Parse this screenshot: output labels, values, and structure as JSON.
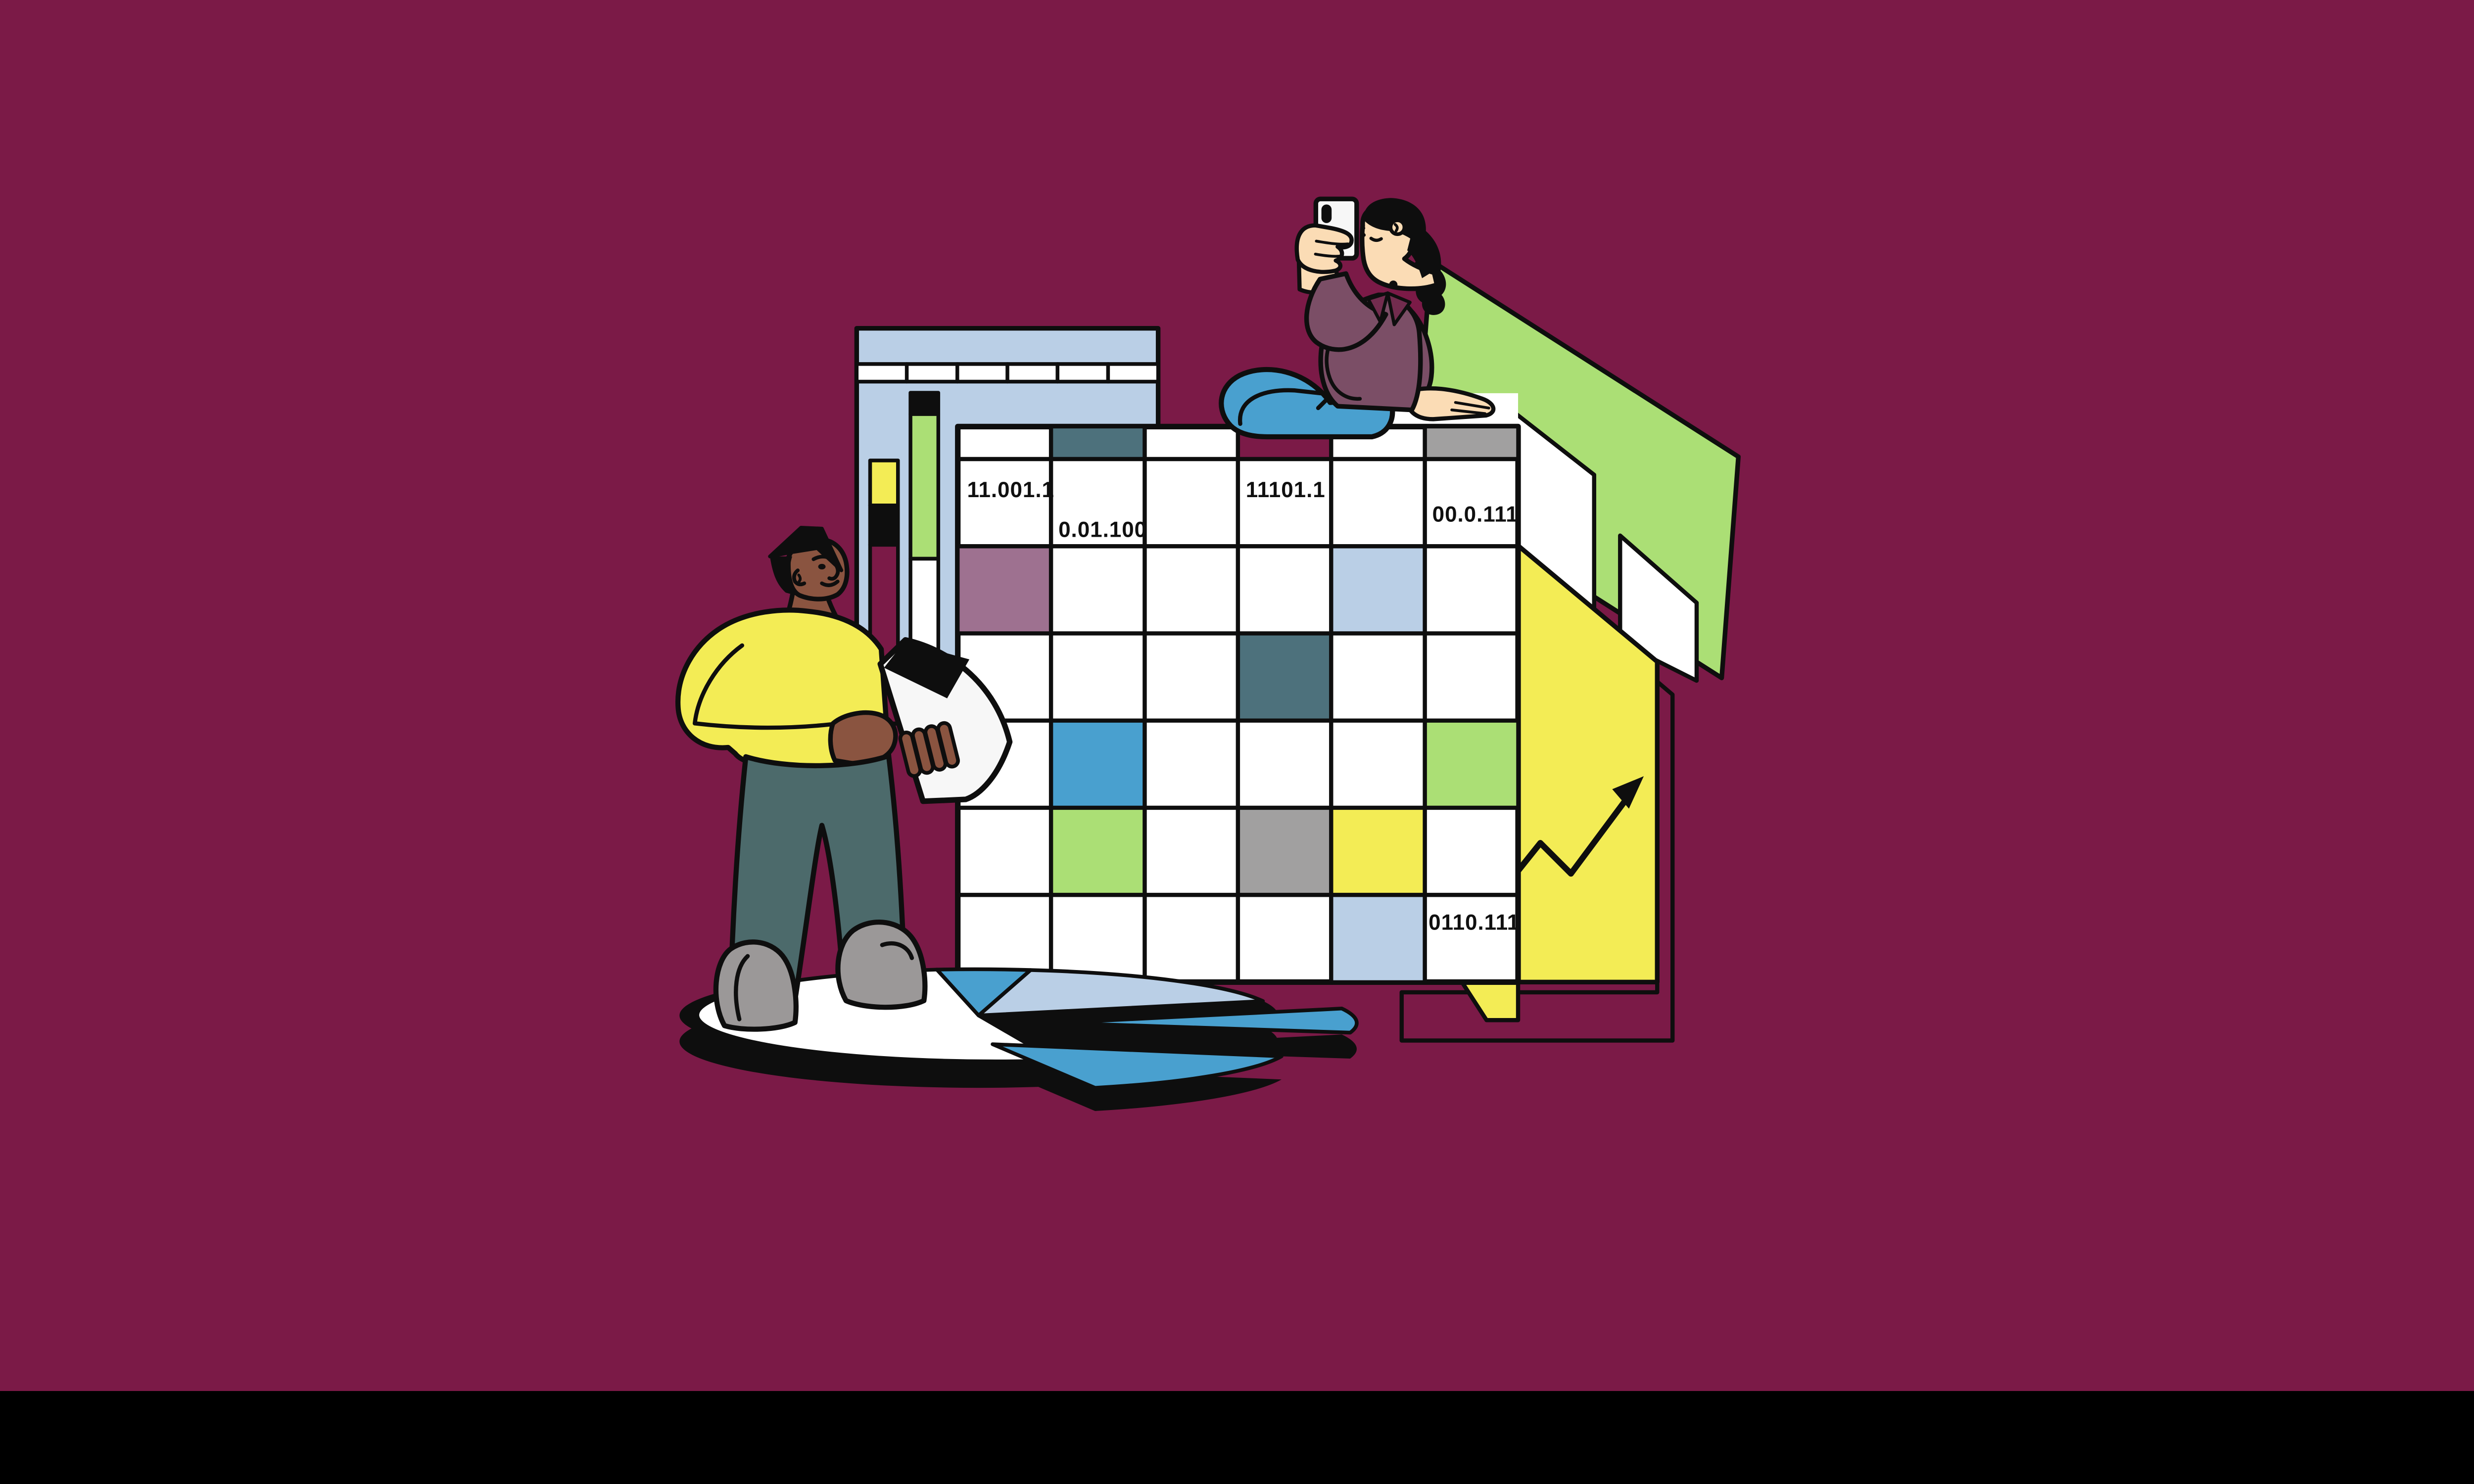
{
  "spreadsheet": {
    "labels": {
      "r1c1": "11.001.1",
      "r1c2": "0.01.100",
      "r1c4": "11101.1",
      "r1c6": "00.0.111",
      "r6c6": "0110.111"
    },
    "colored_cells": [
      {
        "row": 0,
        "col": 2,
        "color": "teal"
      },
      {
        "row": 0,
        "col": 4,
        "color": "burgundy"
      },
      {
        "row": 0,
        "col": 6,
        "color": "gray"
      },
      {
        "row": 2,
        "col": 1,
        "color": "mauve"
      },
      {
        "row": 2,
        "col": 5,
        "color": "light_blue"
      },
      {
        "row": 3,
        "col": 4,
        "color": "teal"
      },
      {
        "row": 4,
        "col": 2,
        "color": "mid_blue"
      },
      {
        "row": 4,
        "col": 6,
        "color": "green"
      },
      {
        "row": 5,
        "col": 2,
        "color": "green"
      },
      {
        "row": 5,
        "col": 4,
        "color": "gray"
      },
      {
        "row": 5,
        "col": 5,
        "color": "yellow"
      },
      {
        "row": 6,
        "col": 5,
        "color": "light_blue"
      }
    ],
    "bar_chart_segments": {
      "bar_a": [
        "yellow",
        "black",
        "burgundy"
      ],
      "bar_b": [
        "black",
        "green",
        "white"
      ]
    }
  },
  "colors": {
    "background": "#7B1A47",
    "ink": "#0e0e0e",
    "paper": "#F7F7F7",
    "white": "#FFFFFF",
    "light_blue": "#BACFE6",
    "mid_blue": "#49A0CF",
    "teal_cell": "#4D717C",
    "slate": "#4C6A6B",
    "mauve": "#9E7190",
    "gray": "#A1A0A0",
    "yellow": "#F3EC55",
    "green": "#ABDF75",
    "plum": "#7B4E66",
    "collar": "#722C4E",
    "skin_light": "#FBDCB5",
    "skin_dark": "#8A5440",
    "shoe_gray": "#9B9898"
  }
}
